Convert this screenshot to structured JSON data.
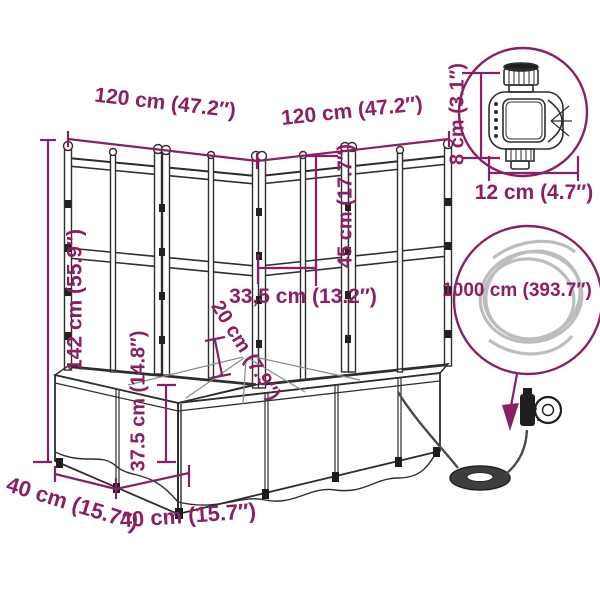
{
  "colors": {
    "dimension_accent": "#8B1F63",
    "line_art": "#2E2E2E"
  },
  "planter": {
    "top_width_left": "120 cm (47.2″)",
    "top_width_right": "120 cm (47.2″)",
    "height_total": "142 cm (55.9″)",
    "trellis_section_height": "45 cm (17.7″)",
    "trellis_panel_width": "33,5 cm (13.2″)",
    "inner_depth": "20 cm (7.9″)",
    "box_height": "37.5 cm (14.8″)",
    "box_depth_left": "40 cm (15.7″)",
    "box_depth_right": "40 cm (15.7″)"
  },
  "water_timer": {
    "height": "8 cm (3.1″)",
    "width": "12 cm (4.7″)"
  },
  "hose": {
    "length": "1000 cm (393.7″)"
  }
}
